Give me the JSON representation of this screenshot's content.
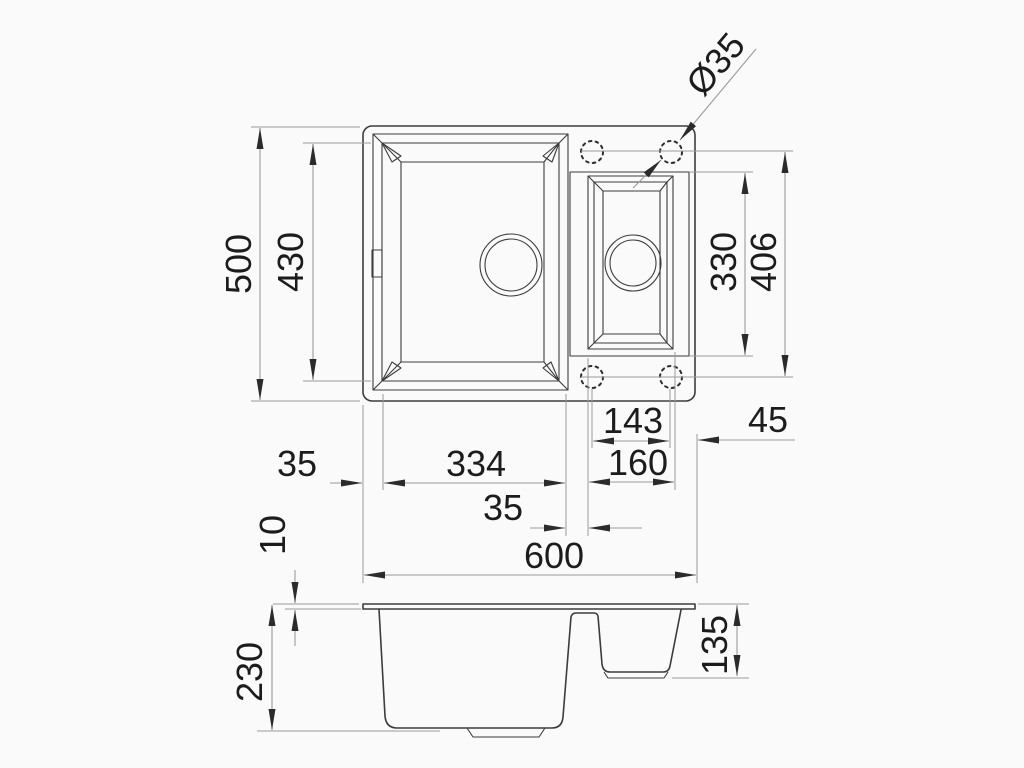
{
  "drawing_type": "sink-technical-drawing",
  "colors": {
    "background": "#fafafa",
    "object_line": "#3c3c3c",
    "dimension_line": "#9b9b9b",
    "text": "#1c1c1c"
  },
  "plan_view": {
    "dims": {
      "overall_width": "600",
      "overall_depth": "500",
      "main_bowl_depth": "430",
      "main_bowl_width": "334",
      "left_rim": "35",
      "divider": "35",
      "small_bowl_width": "160",
      "small_bowl_length": "330",
      "tap_holes_hspan": "143",
      "tap_hole_to_edge": "45",
      "tap_holes_vspan": "406",
      "tap_hole_diameter": "Ø35"
    }
  },
  "section_view": {
    "dims": {
      "rim_thickness": "10",
      "main_bowl_depth": "230",
      "small_bowl_depth": "135"
    }
  }
}
